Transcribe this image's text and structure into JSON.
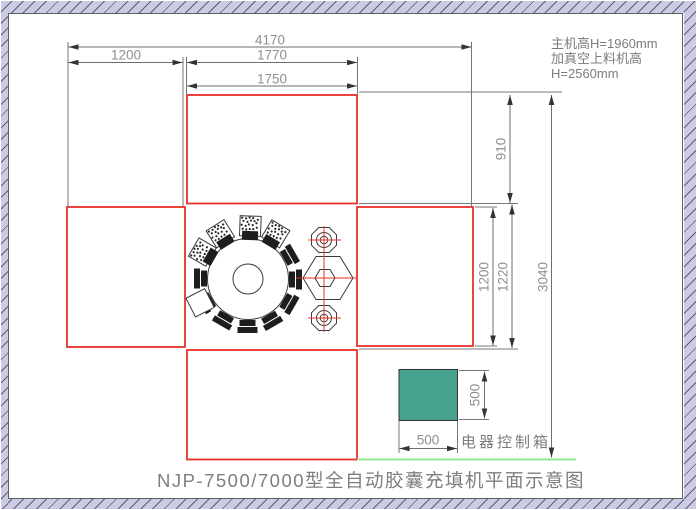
{
  "title": "NJP-7500/7000型全自动胶囊充填机平面示意图",
  "notes": {
    "line1": "主机高H=1960mm",
    "line2": "加真空上料机高",
    "line3": "H=2560mm"
  },
  "dimensions": {
    "overall_width": "4170",
    "left_bay_width": "1200",
    "right_bay_width": "1770",
    "top_module_width": "1750",
    "top_module_height": "910",
    "right_module_height": "1200",
    "center_gap_height": "1220",
    "overall_height": "3040",
    "control_box_width": "500",
    "control_box_height": "500"
  },
  "control_box": {
    "label": "电器控制箱",
    "fill_color": "#46a28c"
  },
  "colors": {
    "module_outline": "#e8312a",
    "dimension_line": "#6e6e6e",
    "arrow": "#333333",
    "text_gray": "#7c7c7c",
    "floor_line_green": "#90e690",
    "frame_hatch": "#cbcbe4",
    "machine_outline": "#3a3a3a"
  }
}
